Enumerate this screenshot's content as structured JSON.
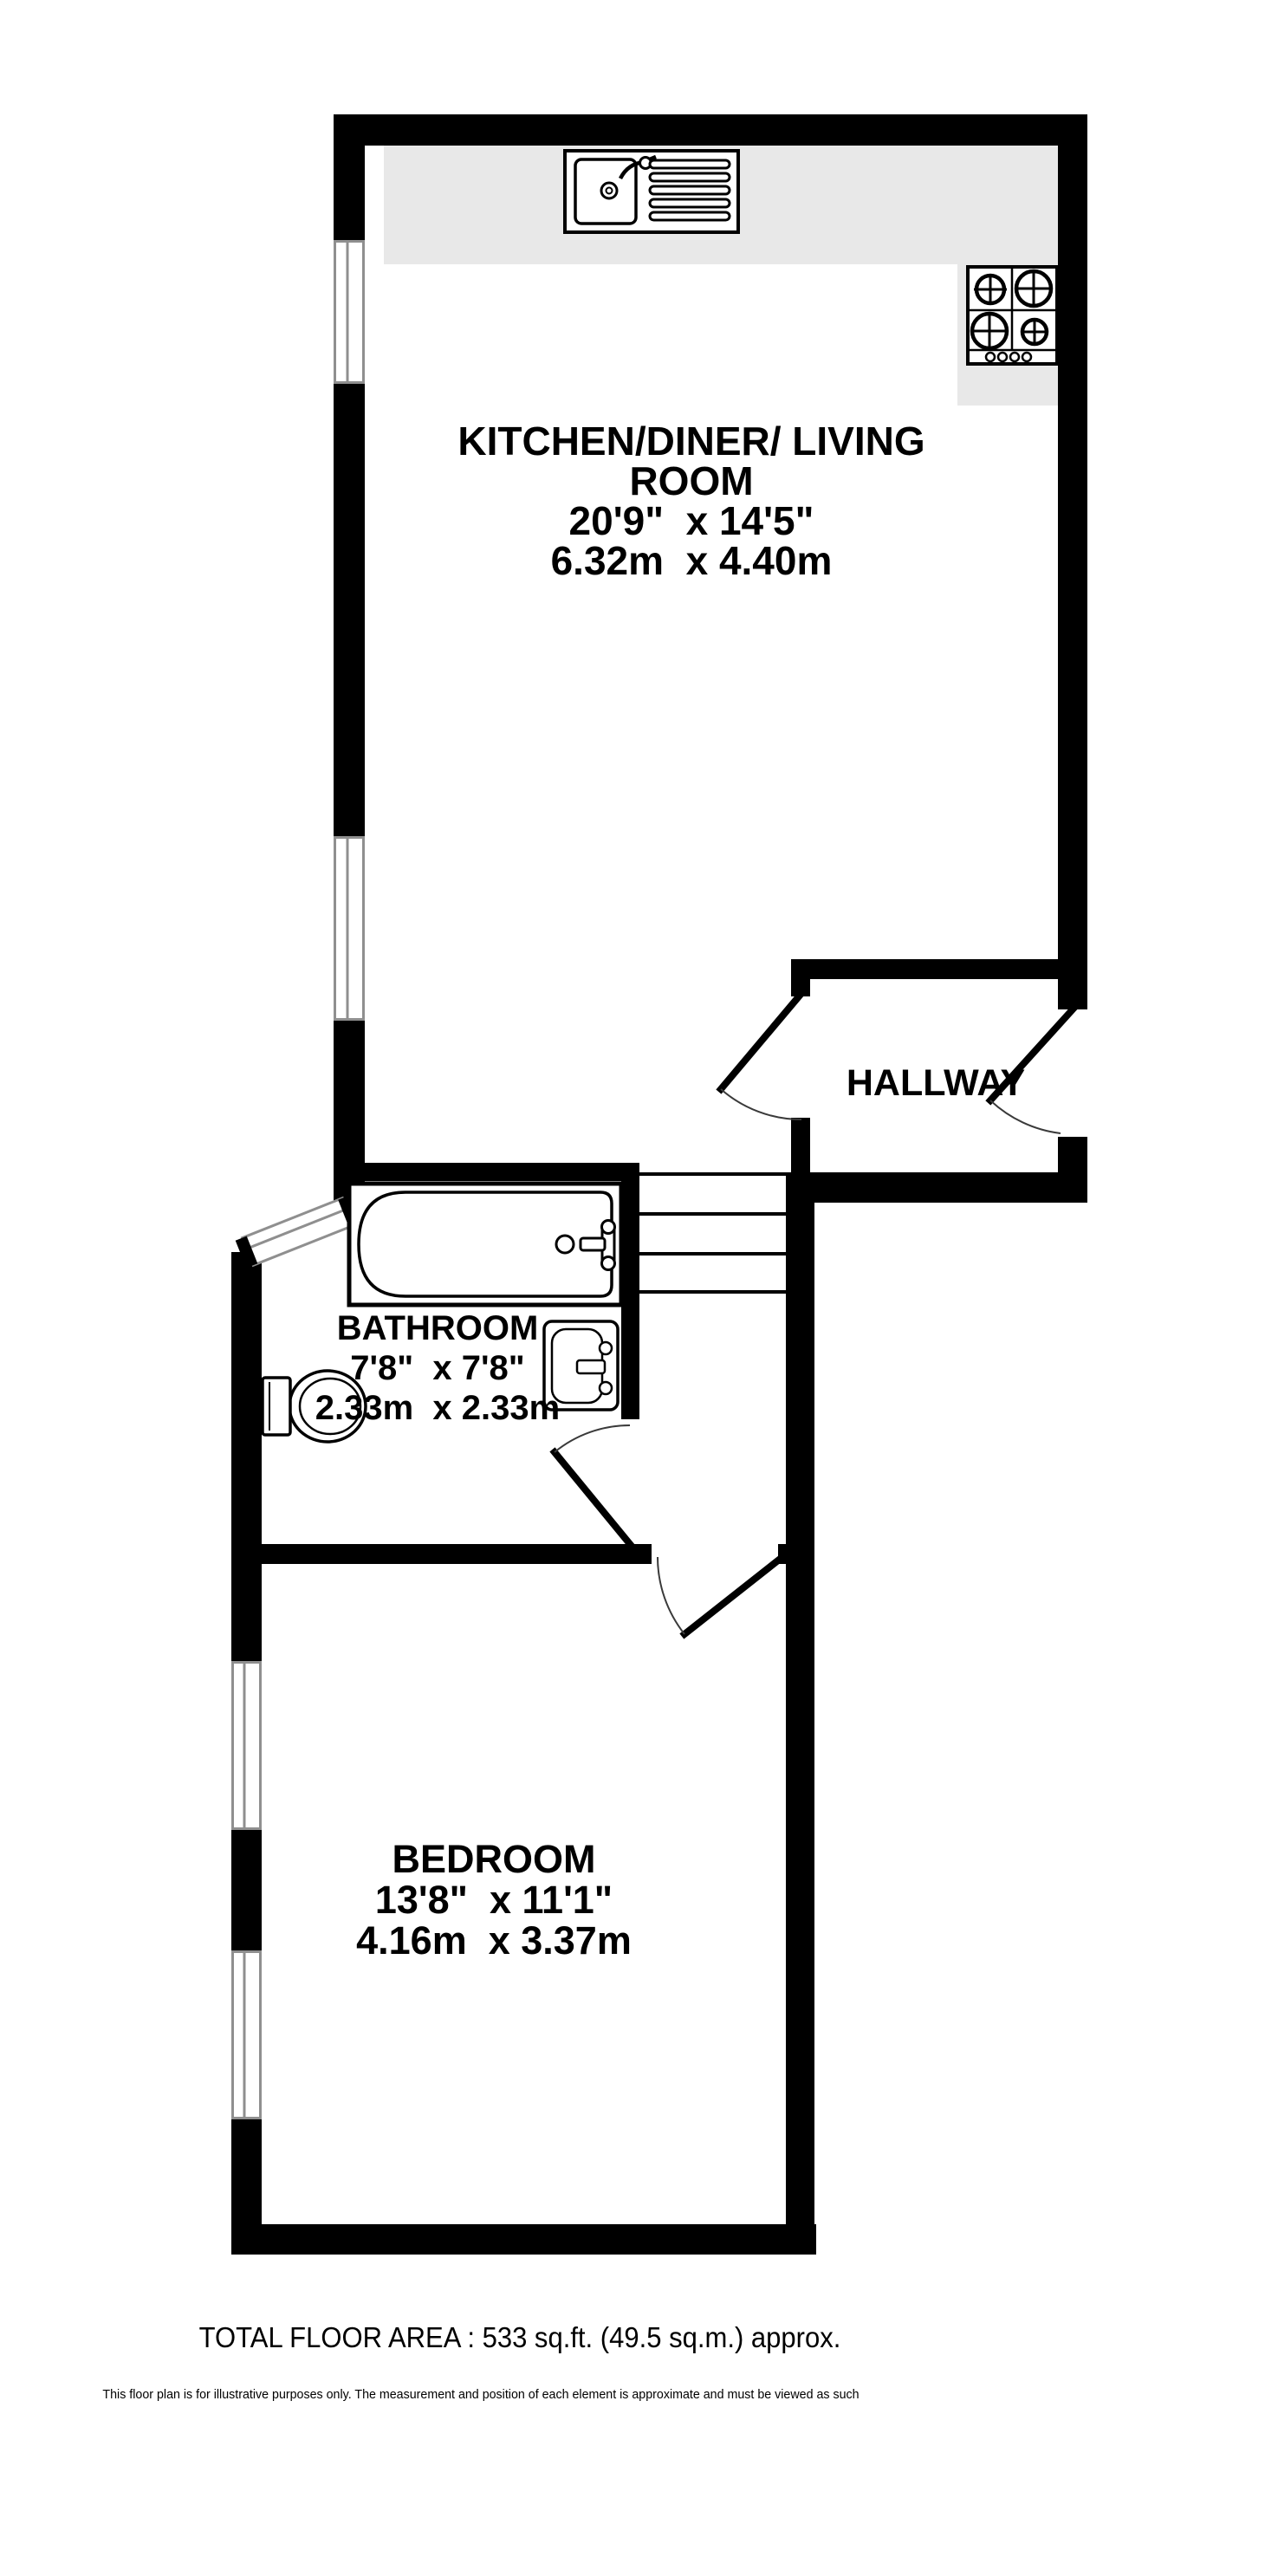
{
  "plan": {
    "rooms": {
      "kitchen": {
        "label_line1": "KITCHEN/DINER/ LIVING",
        "label_line2": "ROOM",
        "dims_imperial": "20'9\"  x 14'5\"",
        "dims_metric": "6.32m  x 4.40m"
      },
      "hallway": {
        "label": "HALLWAY"
      },
      "bathroom": {
        "label": "BATHROOM",
        "dims_imperial": "7'8\"  x 7'8\"",
        "dims_metric": "2.33m  x 2.33m"
      },
      "bedroom": {
        "label": "BEDROOM",
        "dims_imperial": "13'8\"  x 11'1\"",
        "dims_metric": "4.16m  x 3.37m"
      }
    },
    "fixtures": {
      "kitchen_sink": "sink-with-drainer-icon",
      "hob": "four-burner-hob-icon",
      "bathtub": "bathtub-icon",
      "basin": "washbasin-icon",
      "toilet": "toilet-icon",
      "steps": "steps-icon",
      "windows": "triple-line-window-icon",
      "doors": "door-swing-icon"
    },
    "colors": {
      "wall": "#000000",
      "counter": "#e8e8e8",
      "window_line": "#8f8f8f",
      "door_arc": "#3a3a3a"
    }
  },
  "footer": {
    "total_area": "TOTAL FLOOR AREA : 533 sq.ft. (49.5 sq.m.) approx.",
    "disclaimer": "This floor plan is for illustrative purposes only. The measurement and position of each element is approximate and must be viewed as such"
  }
}
